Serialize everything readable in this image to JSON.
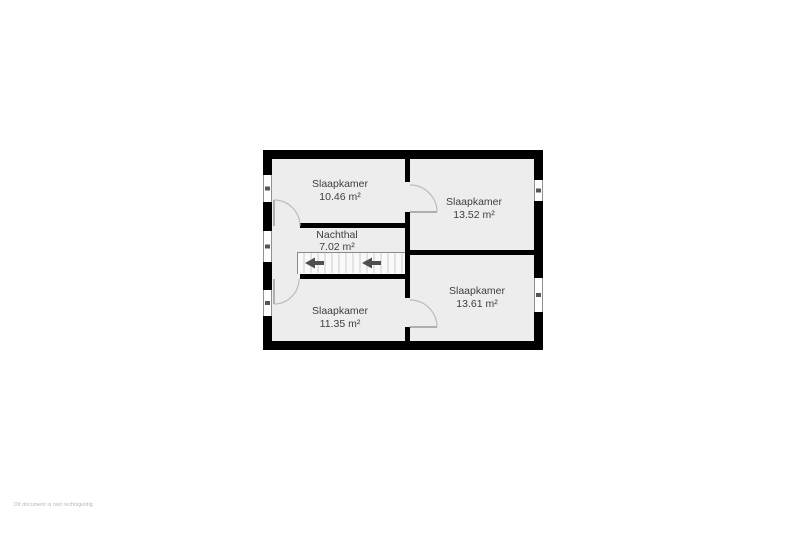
{
  "rooms": [
    {
      "id": "slaapkamer-top-left",
      "name": "Slaapkamer",
      "area": "10.46 m²"
    },
    {
      "id": "slaapkamer-top-right",
      "name": "Slaapkamer",
      "area": "13.52 m²"
    },
    {
      "id": "nachthal",
      "name": "Nachthal",
      "area": "7.02 m²"
    },
    {
      "id": "slaapkamer-bottom-left",
      "name": "Slaapkamer",
      "area": "11.35 m²"
    },
    {
      "id": "slaapkamer-bottom-right",
      "name": "Slaapkamer",
      "area": "13.61 m²"
    }
  ],
  "footer_note": "Dit document is niet rechtsgeldig",
  "colors": {
    "wall": "#000000",
    "floor": "#ededed",
    "background": "#ffffff",
    "label": "#3e3e3e",
    "door-arc": "#bcbcbc",
    "arrow": "#4f4f4f",
    "footer": "#b3b3b3"
  }
}
